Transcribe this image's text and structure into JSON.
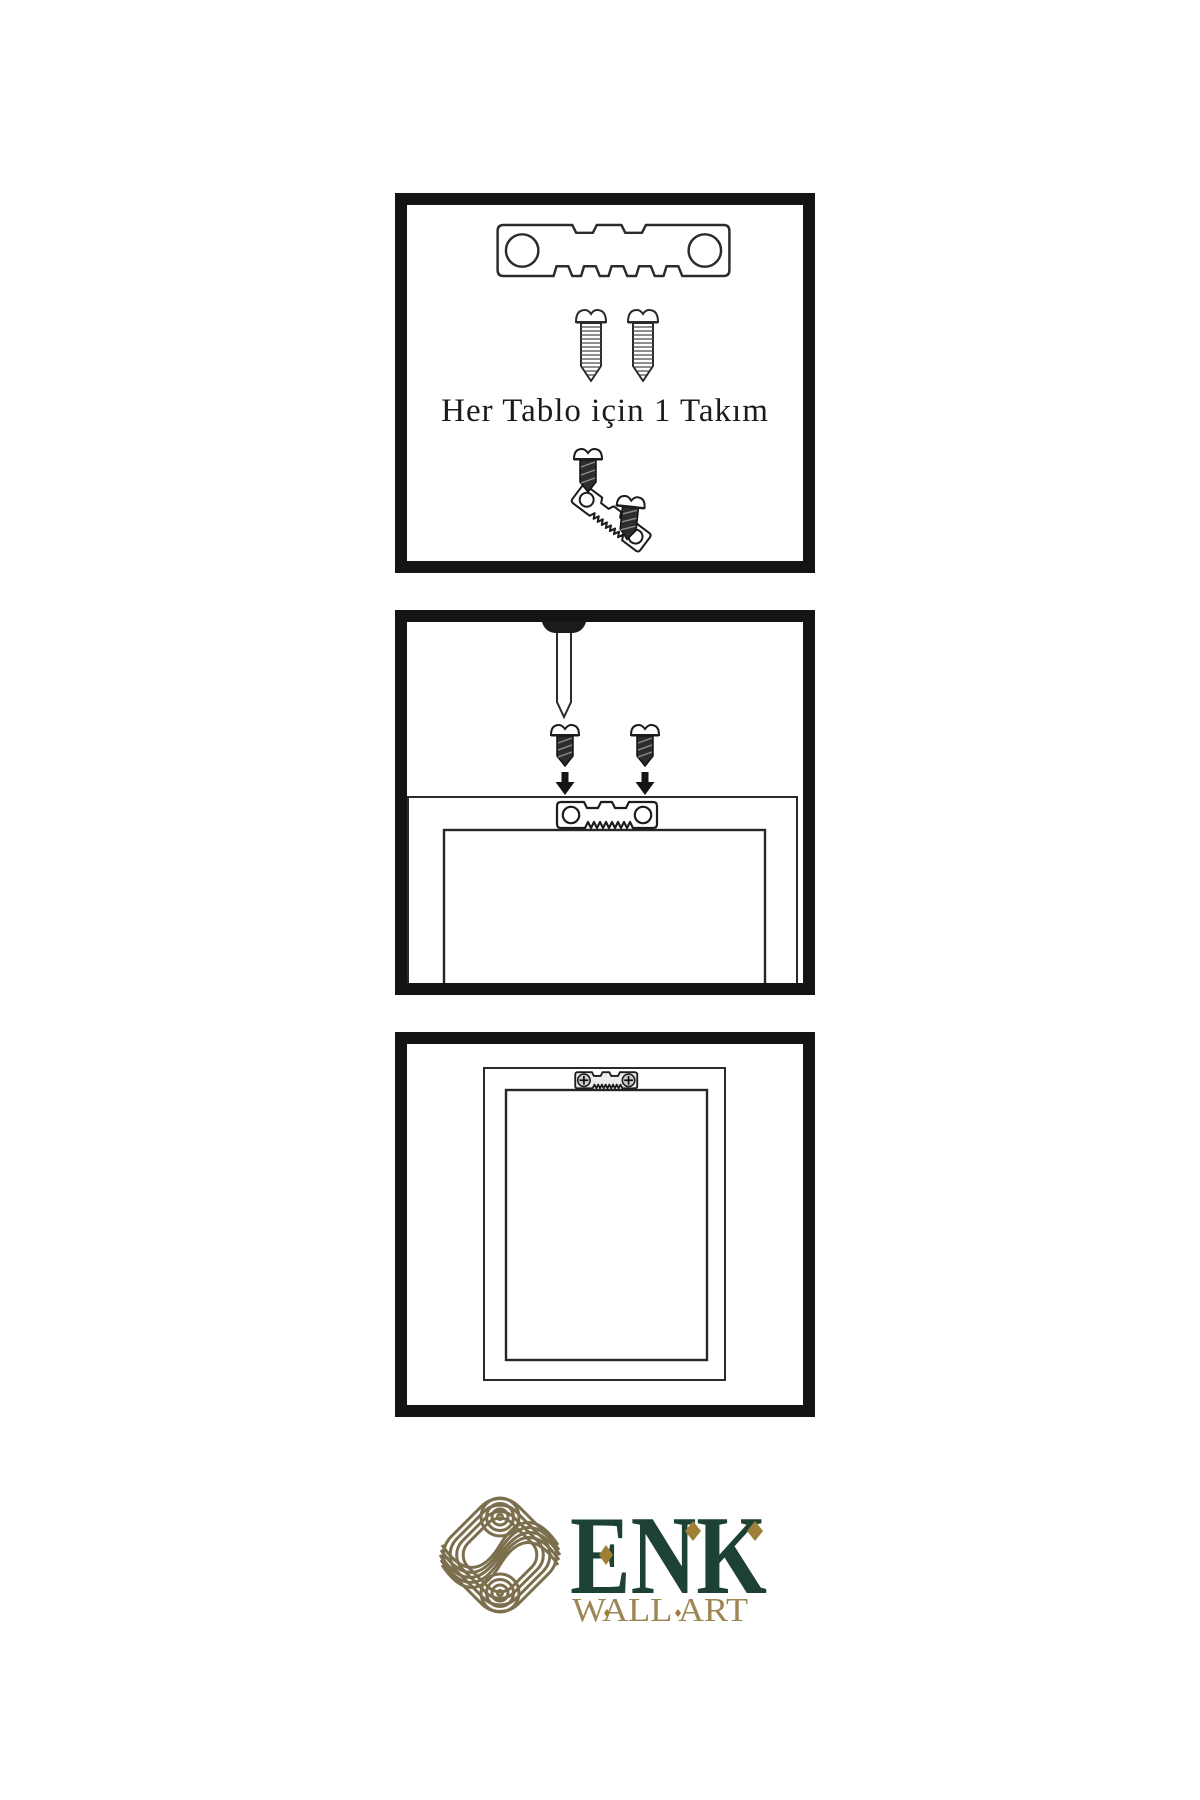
{
  "page": {
    "background": "#ffffff"
  },
  "colors": {
    "line": "#2b2b2b",
    "panel_border": "#141414",
    "dark_fill": "#1f1f1f",
    "logo_green": "#1d4234",
    "logo_gold": "#9c8654",
    "knot_gold": "#7b6f4e",
    "diamond_gold": "#9d7f35"
  },
  "steps": [
    {
      "name": "hardware-kit",
      "caption": "Her Tablo için 1 Takım",
      "icons": [
        "sawtooth-hanger-icon",
        "screw-icon",
        "screw-icon",
        "tilted-hanger-with-screws-icon"
      ]
    },
    {
      "name": "attach-hanger-to-frame",
      "icons": [
        "nail-icon",
        "dark-screw-icon",
        "dark-screw-icon",
        "down-arrow-icon",
        "down-arrow-icon",
        "frame-back-outline",
        "sawtooth-hanger-icon"
      ]
    },
    {
      "name": "hanger-installed-on-frame",
      "icons": [
        "frame-back-outline",
        "installed-sawtooth-hanger-icon",
        "phillips-screw-icon",
        "phillips-screw-icon"
      ]
    }
  ],
  "logo": {
    "brand": "ENK",
    "subtitle": "WALL ART",
    "symbol": "interlocking-knot-icon"
  }
}
